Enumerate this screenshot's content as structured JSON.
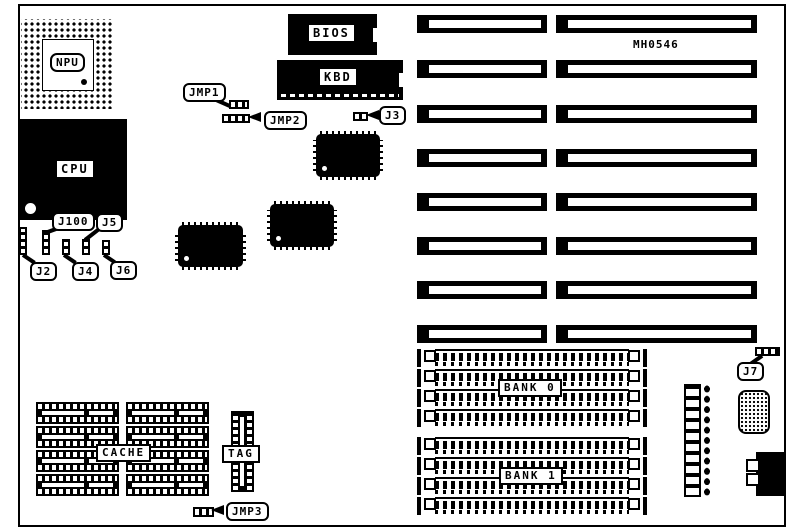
{
  "diagram": {
    "part_number": "MH0546",
    "labels": {
      "npu": "NPU",
      "cpu": "CPU",
      "bios": "BIOS",
      "kbd": "KBD",
      "jmp1": "JMP1",
      "jmp2": "JMP2",
      "jmp3": "JMP3",
      "j2": "J2",
      "j3": "J3",
      "j4": "J4",
      "j5": "J5",
      "j6": "J6",
      "j7": "J7",
      "j100": "J100",
      "bank0": "BANK 0",
      "bank1": "BANK 1",
      "cache": "CACHE",
      "tag": "TAG"
    }
  }
}
